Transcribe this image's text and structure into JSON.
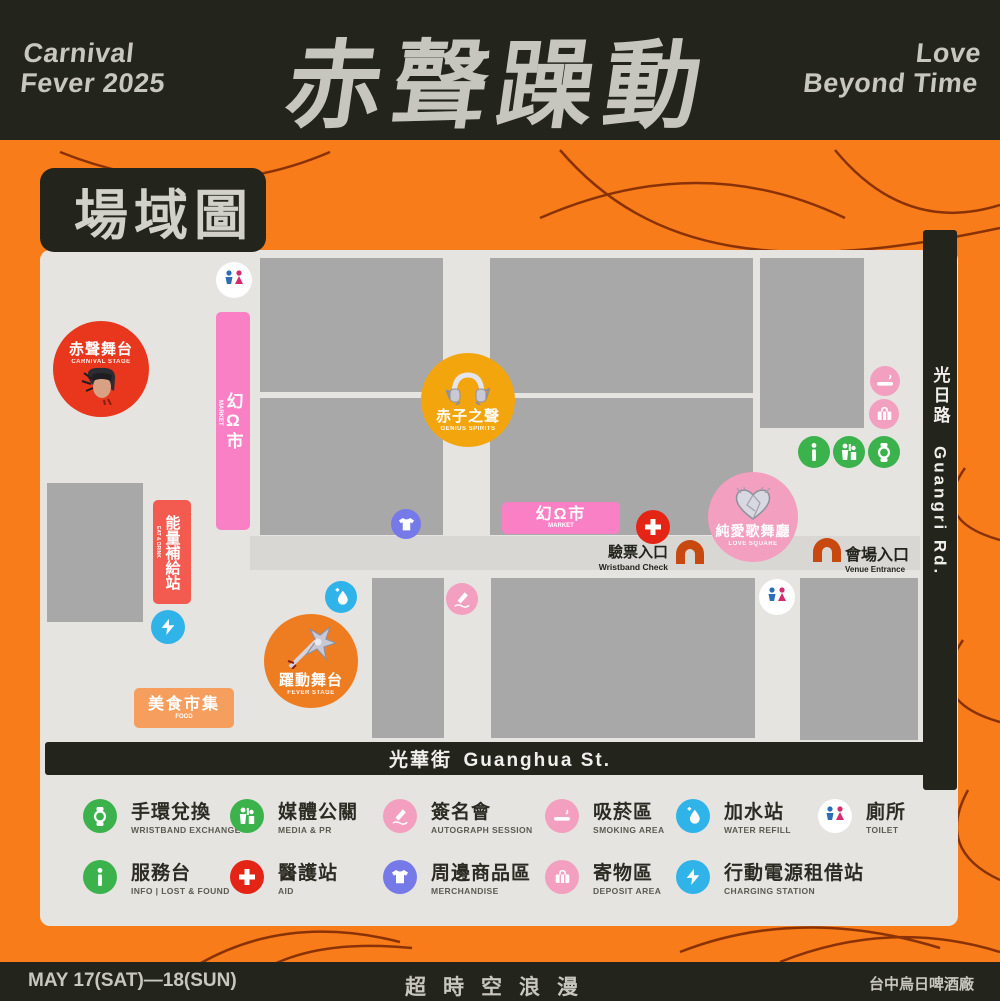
{
  "header": {
    "event_left": [
      "Carnival",
      "Fever 2025"
    ],
    "title_zh": "赤聲躁動",
    "event_right": [
      "Love",
      "Beyond Time"
    ]
  },
  "map_title": "場域圖",
  "roads": {
    "right_zh": "光日路",
    "right_en": "Guangri Rd.",
    "bottom_zh": "光華街",
    "bottom_en": "Guanghua St."
  },
  "markers": {
    "carnival_stage": {
      "zh": "赤聲舞台",
      "en": "CARNIVAL STAGE"
    },
    "market_vertical": {
      "zh": "幻Ω市",
      "en": "MARKET"
    },
    "market_horizontal": {
      "zh": "幻Ω市",
      "en": "MARKET"
    },
    "pure_voice": {
      "zh": "赤子之聲",
      "en": "GENIUS SPIRITS"
    },
    "love_square": {
      "zh": "純愛歌舞廳",
      "en": "LOVE SQUARE"
    },
    "fever_stage": {
      "zh": "躍動舞台",
      "en": "FEVER STAGE"
    },
    "energy_station": {
      "zh": "能量補給站",
      "en": "EAT & DRINK"
    },
    "food_market": {
      "zh": "美食市集",
      "en": "FOOD"
    },
    "wristband_check": {
      "zh": "驗票入口",
      "en": "Wristband Check"
    },
    "venue_entrance": {
      "zh": "會場入口",
      "en": "Venue Entrance"
    }
  },
  "legend": {
    "items": [
      {
        "zh": "手環兌換",
        "en": "WRISTBAND EXCHANGE",
        "color": "#3bb24c",
        "icon": "wristband-icon"
      },
      {
        "zh": "媒體公關",
        "en": "MEDIA & PR",
        "color": "#3bb24c",
        "icon": "media-icon"
      },
      {
        "zh": "簽名會",
        "en": "AUTOGRAPH SESSION",
        "color": "#f29fc0",
        "icon": "autograph-icon"
      },
      {
        "zh": "吸菸區",
        "en": "SMOKING AREA",
        "color": "#f29fc0",
        "icon": "smoking-icon"
      },
      {
        "zh": "加水站",
        "en": "WATER REFILL",
        "color": "#2fb3e8",
        "icon": "water-icon"
      },
      {
        "zh": "廁所",
        "en": "TOILET",
        "color": "#ffffff",
        "icon": "toilet-icon"
      },
      {
        "zh": "服務台",
        "en": "INFO | LOST & FOUND",
        "color": "#3bb24c",
        "icon": "info-icon"
      },
      {
        "zh": "醫護站",
        "en": "AID",
        "color": "#e42516",
        "icon": "aid-icon"
      },
      {
        "zh": "周邊商品區",
        "en": "MERCHANDISE",
        "color": "#7679e8",
        "icon": "merch-icon"
      },
      {
        "zh": "寄物區",
        "en": "DEPOSIT AREA",
        "color": "#f29fc0",
        "icon": "deposit-icon"
      },
      {
        "zh": "行動電源租借站",
        "en": "CHARGING STATION",
        "color": "#2fb3e8",
        "icon": "charging-icon"
      }
    ]
  },
  "footer": {
    "date": "MAY 17(SAT)—18(SUN)",
    "slogan": "超時空浪漫",
    "venue": "台中烏日啤酒廠"
  },
  "colors": {
    "background_orange": "#f97c1a",
    "bar_black": "#23241c",
    "panel_grey": "#e6e4e1",
    "block_grey": "#a8a8a8",
    "road_grey": "#d9d7d4",
    "stage_red": "#e8371d",
    "aid_red": "#e42516",
    "voice_orange": "#f3a50e",
    "fever_orange": "#ee7d22",
    "food_orange": "#f69e5e",
    "energy_red": "#f35a50",
    "market_pink": "#f980c5",
    "soft_pink": "#f29fc0",
    "merch_purple": "#7679e8",
    "utility_blue": "#2fb3e8",
    "service_green": "#3bb24c",
    "arch_red": "#c7490f",
    "toilet_male_blue": "#2b6db8",
    "toilet_female_pink": "#d42a70"
  }
}
